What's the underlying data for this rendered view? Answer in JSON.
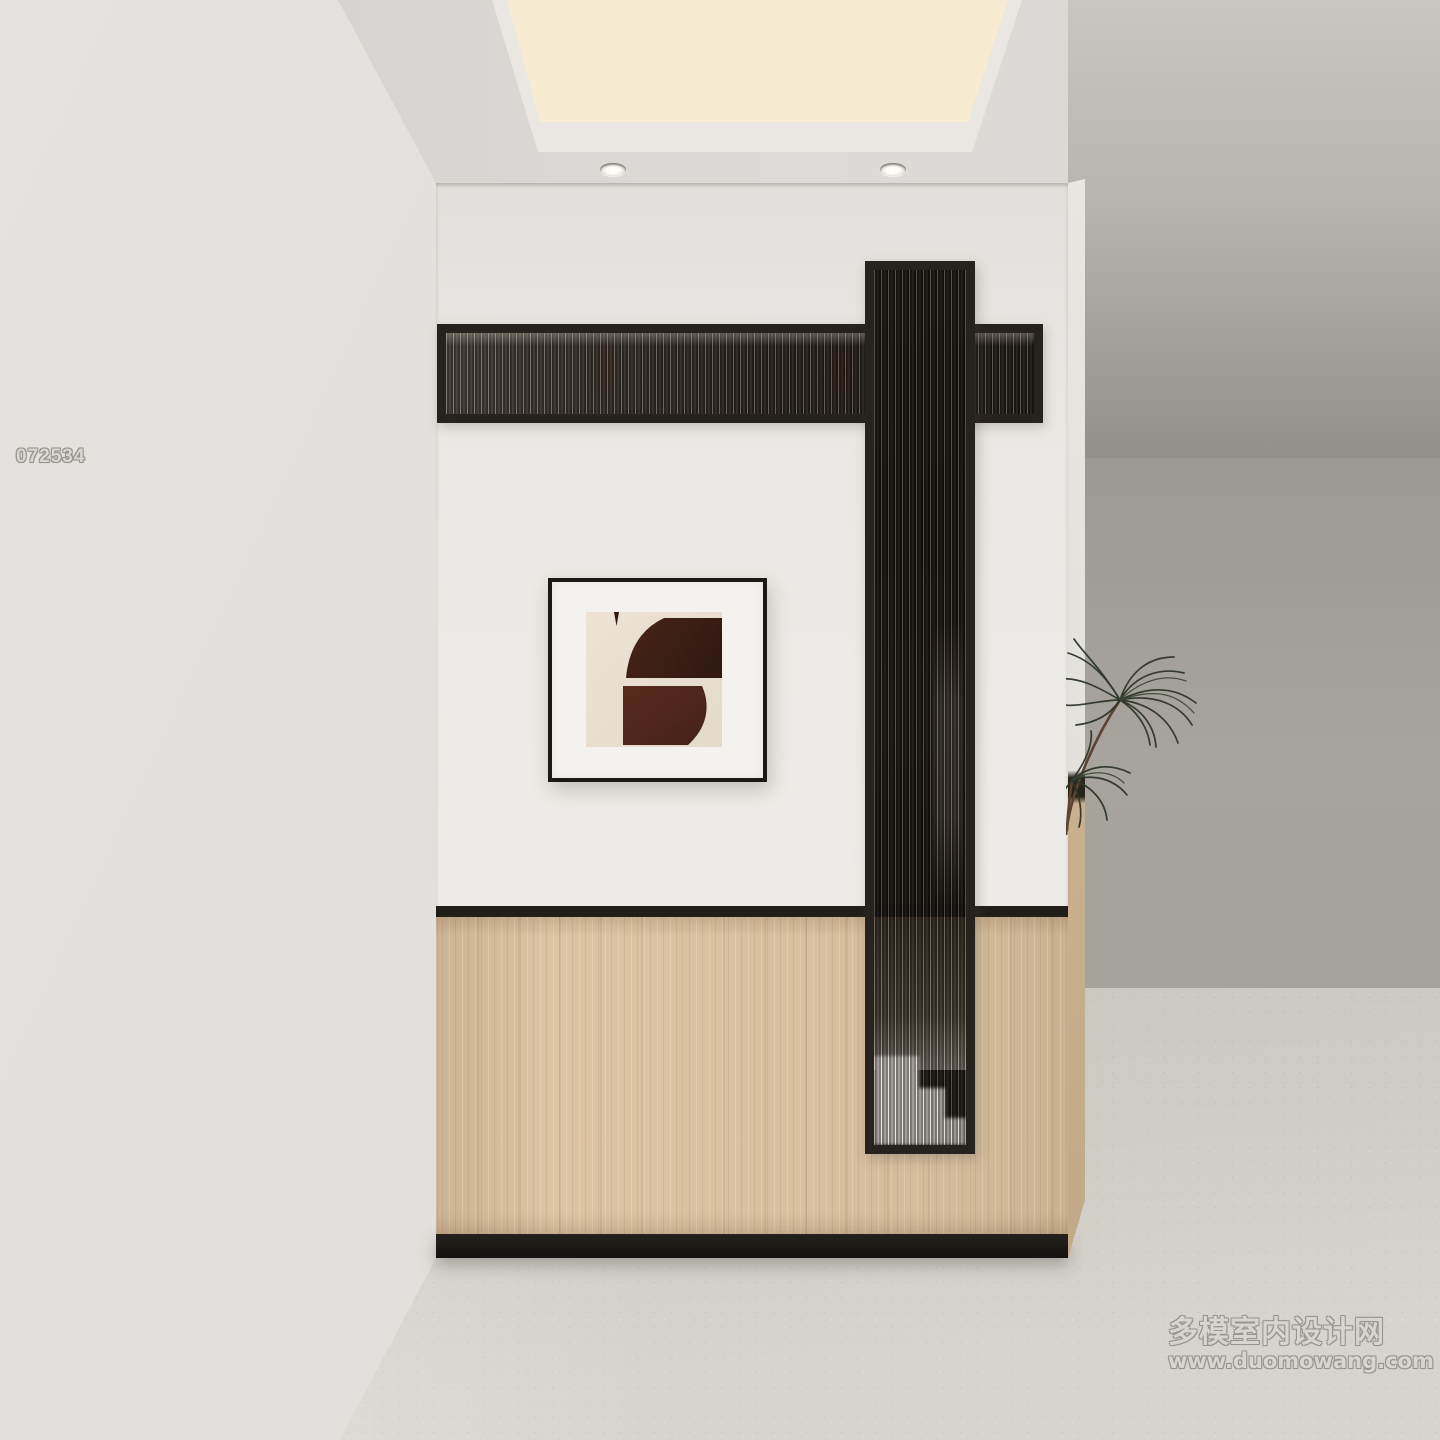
{
  "watermarks": {
    "id_code": "072534",
    "site_name": "多模室内设计网",
    "site_url": "www.duomowang.com"
  },
  "palette": {
    "wall_white": "#eceae6",
    "left_wall": "#e1dfdb",
    "ceiling": "#d9d7d3",
    "cove_light_warm": "#f5e9cf",
    "wood_panel": "#d8bf9f",
    "black_trim": "#1e1b17",
    "screen_frame": "#26221d",
    "distant_wall": "#a5a19b",
    "floor": "#cfccc6",
    "leaf_green": "#2c3627",
    "art_brown_dark": "#3c1e16",
    "art_brown_light": "#55271c",
    "art_background": "#e8decf"
  }
}
